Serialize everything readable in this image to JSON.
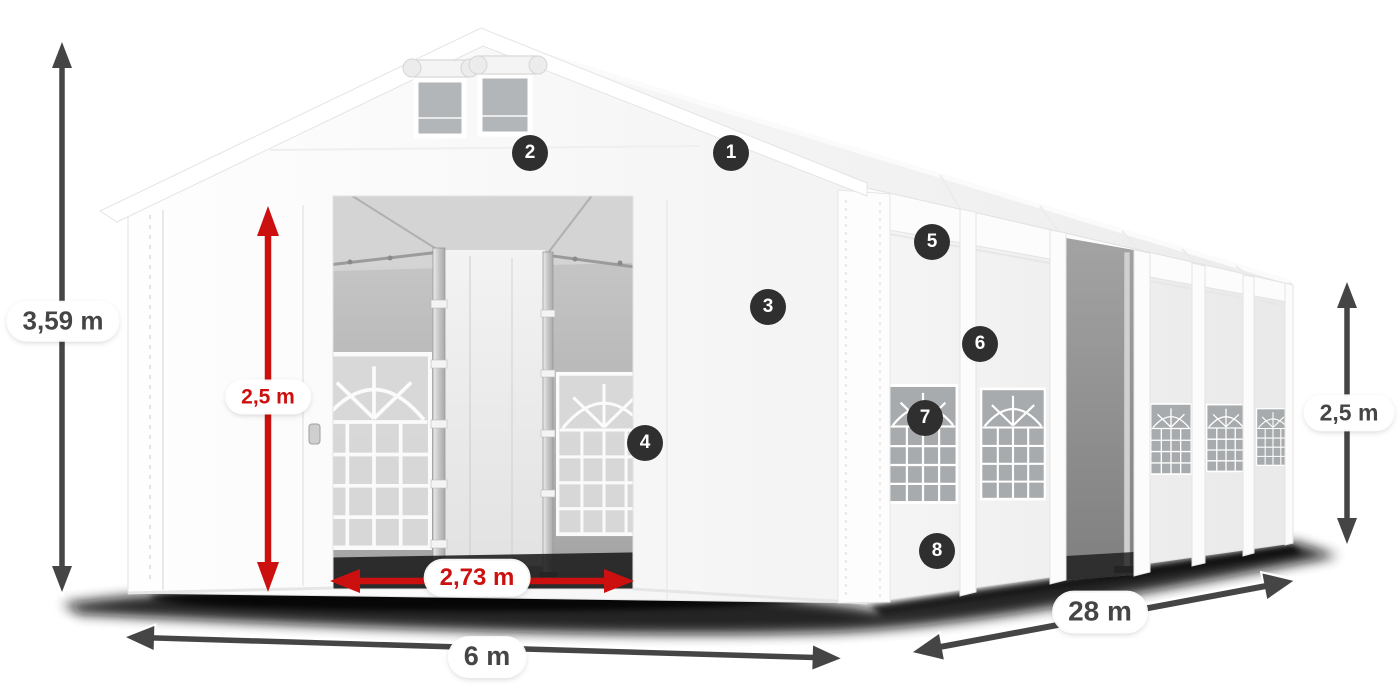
{
  "colors": {
    "accent_red": "#cc1010",
    "dimension_dark": "#454545",
    "callout_bg": "#2f2f2f",
    "callout_text": "#ffffff",
    "pill_bg": "#ffffff"
  },
  "dimensions": {
    "total_height": {
      "label": "3,59 m",
      "style": "dark",
      "pos": {
        "x": 63,
        "y": 321
      }
    },
    "door_height": {
      "label": "2,5 m",
      "style": "red",
      "pos": {
        "x": 268,
        "y": 397
      }
    },
    "door_width": {
      "label": "2,73 m",
      "style": "red",
      "pos": {
        "x": 477,
        "y": 578
      }
    },
    "ground_width": {
      "label": "6 m",
      "style": "dark",
      "pos": {
        "x": 487,
        "y": 657
      }
    },
    "length": {
      "label": "28 m",
      "style": "dark",
      "pos": {
        "x": 1100,
        "y": 612
      }
    },
    "side_height": {
      "label": "2,5 m",
      "style": "dark",
      "pos": {
        "x": 1349,
        "y": 413
      }
    }
  },
  "callouts": [
    {
      "number": "1",
      "pos": {
        "x": 731,
        "y": 153
      }
    },
    {
      "number": "2",
      "pos": {
        "x": 530,
        "y": 153
      }
    },
    {
      "number": "3",
      "pos": {
        "x": 768,
        "y": 307
      }
    },
    {
      "number": "4",
      "pos": {
        "x": 645,
        "y": 443
      }
    },
    {
      "number": "5",
      "pos": {
        "x": 932,
        "y": 242
      }
    },
    {
      "number": "6",
      "pos": {
        "x": 980,
        "y": 344
      }
    },
    {
      "number": "7",
      "pos": {
        "x": 925,
        "y": 418
      }
    },
    {
      "number": "8",
      "pos": {
        "x": 937,
        "y": 551
      }
    }
  ]
}
